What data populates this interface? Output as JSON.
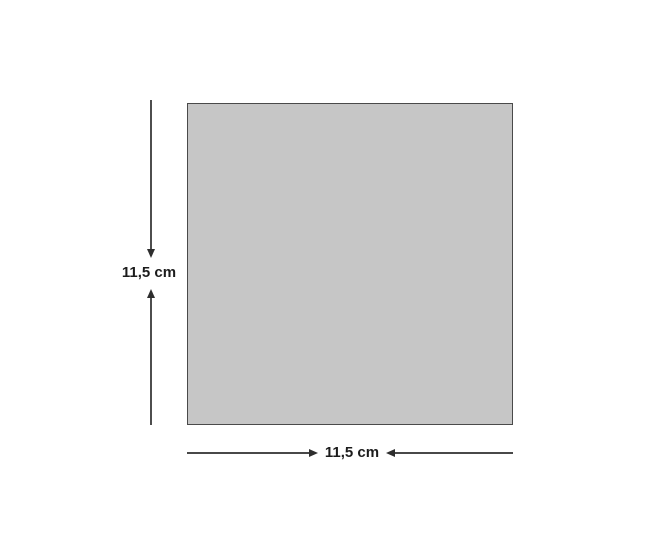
{
  "diagram": {
    "shape": "square",
    "height_label": "11,5 cm",
    "width_label": "11,5 cm",
    "colors": {
      "background": "#ffffff",
      "square_fill": "#c6c6c6",
      "square_border": "#4a4a4a",
      "dimension_line": "#2e2e2e",
      "label_text": "#1c1c1c"
    }
  }
}
